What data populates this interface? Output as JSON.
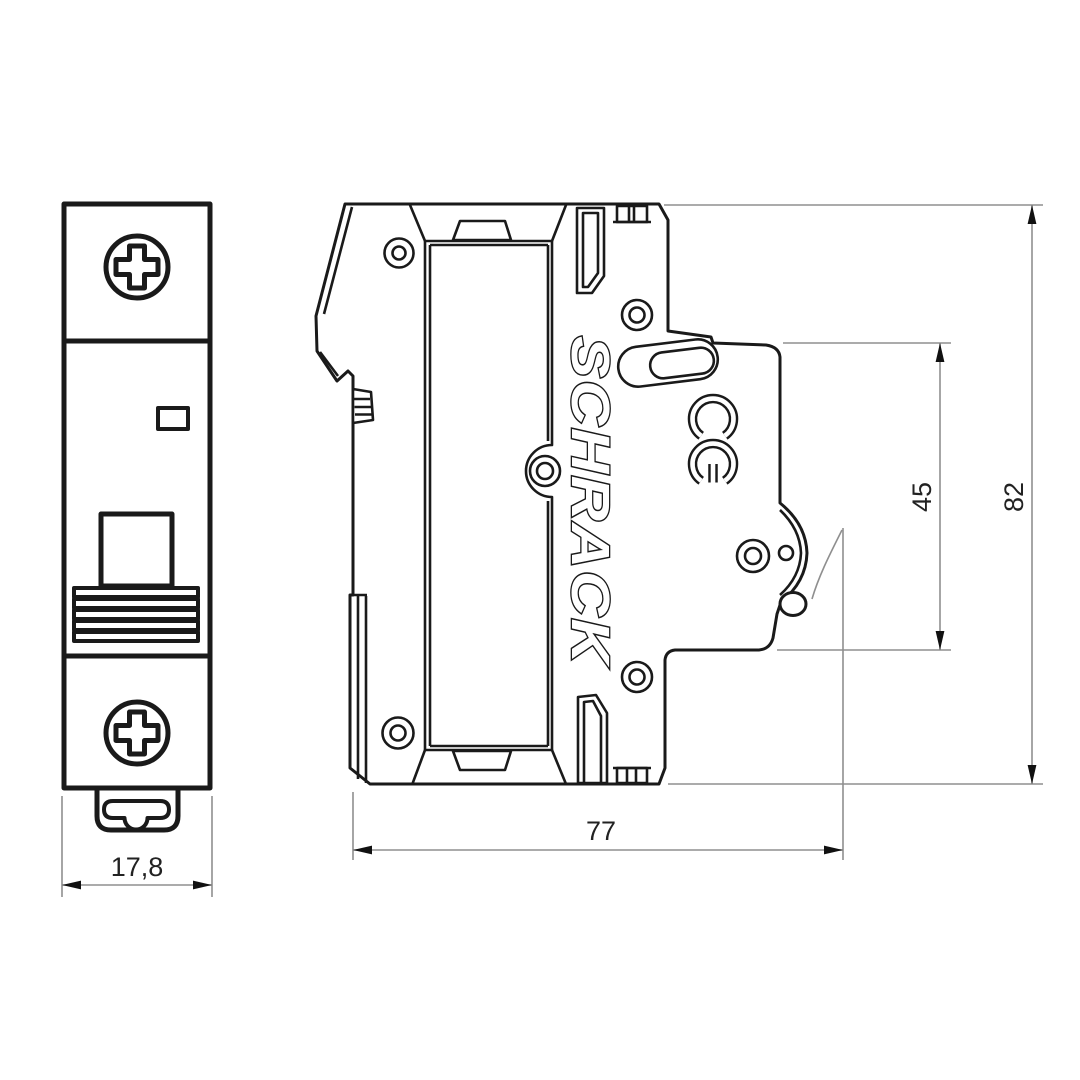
{
  "drawing": {
    "brand": "SCHRACK",
    "ce_mark": "CE",
    "dimensions": {
      "front_width": "17,8",
      "depth": "77",
      "front_section_height": "45",
      "overall_height": "82"
    },
    "colors": {
      "background": "#ffffff",
      "line": "#1a1a1a",
      "dimension_line": "#8f8f8f",
      "dimension_text": "#222222",
      "indicator_fill": "#b9b9b9"
    }
  }
}
